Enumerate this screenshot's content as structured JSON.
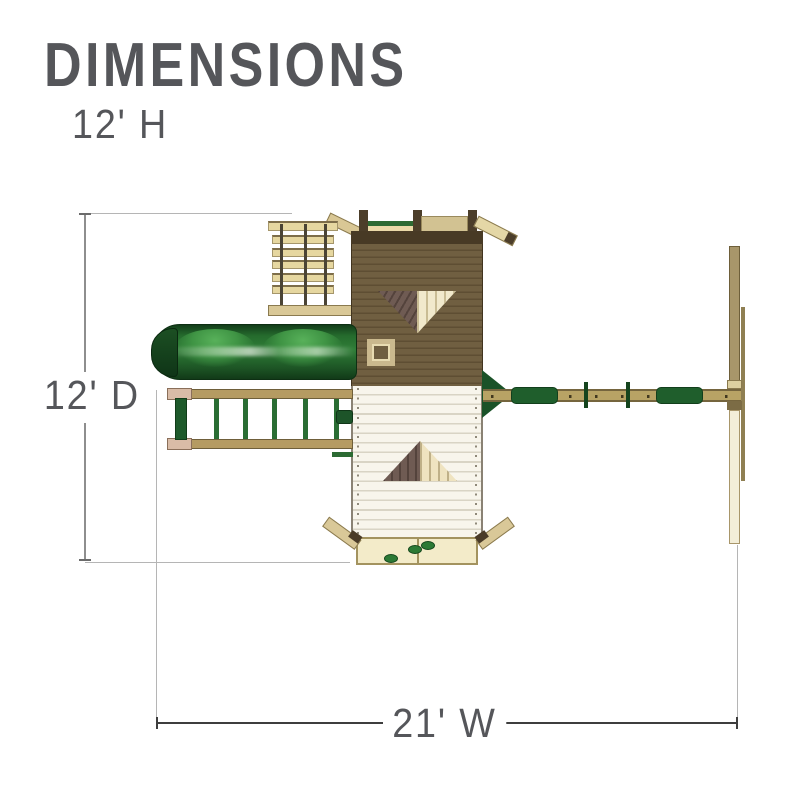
{
  "header": {
    "title": "DIMENSIONS",
    "height_label": "12' H"
  },
  "dimensions": {
    "depth_label": "12' D",
    "width_label": "21' W"
  },
  "diagram": {
    "view": "top-down plan of wooden playset",
    "parts": [
      "rope-ladder",
      "roof",
      "gable-window",
      "skylight-window",
      "porch-roof",
      "porch-gable-window",
      "climbing-wall",
      "tube-slide",
      "access-ladder",
      "telescope",
      "swing-beam",
      "swing-hangers",
      "swing-frame"
    ],
    "colors": {
      "text_gray": "#55565a",
      "dimension_line": "#3e3e3e",
      "extension_line": "#b5b5b5",
      "roof_brown": "#705f41",
      "ridge_brown": "#483a25",
      "wood_tan": "#d9c897",
      "beam_tan": "#b8a365",
      "slide_green": "#2f7d37",
      "accent_green": "#1f5e2c",
      "porch_cream": "#f8f5ec",
      "window_mauve": "#6f5b53"
    }
  }
}
